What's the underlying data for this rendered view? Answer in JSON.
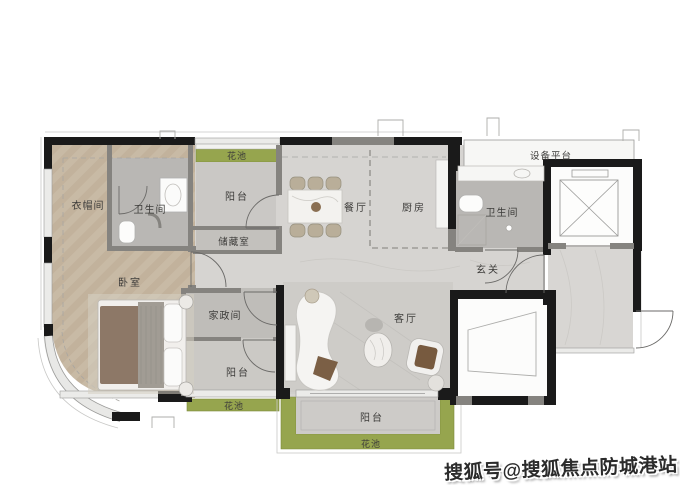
{
  "rooms": {
    "cloakroom": "衣帽间",
    "bathroom1": "卫生间",
    "flower_top": "花池",
    "balcony_top": "阳台",
    "storage": "储藏室",
    "bedroom": "卧室",
    "dining": "餐厅",
    "kitchen": "厨房",
    "equipment_platform": "设备平台",
    "bathroom2": "卫生间",
    "foyer": "玄关",
    "housekeeping": "家政间",
    "balcony_left": "阳台",
    "flower_left": "花池",
    "living": "客厅",
    "balcony_bottom": "阳台",
    "flower_bottom": "花池"
  },
  "watermark": {
    "text": "搜狐号@搜狐焦点防城港站"
  },
  "palette": {
    "exterior_wall": "#1a1a1a",
    "partition_wall": "#85837f",
    "wood_floor": "#c8baa5",
    "marble_floor": "#d6d4d1",
    "bath_floor": "#b9b7b4",
    "balcony_floor": "#cac8c5",
    "flower_bed_green": "#96a54e",
    "label_text": "#3d3c3a"
  }
}
